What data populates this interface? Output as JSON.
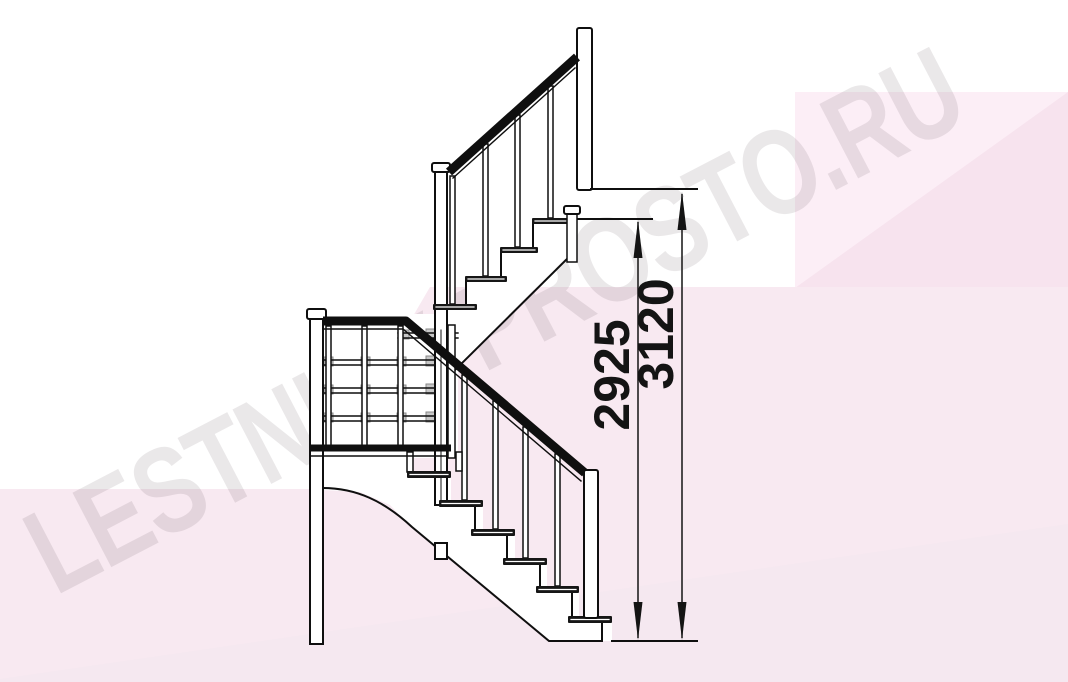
{
  "watermark": {
    "text": "LESTNICY-PROSTO.RU"
  },
  "dimensions": {
    "inner": {
      "value": "2925"
    },
    "outer": {
      "value": "3120"
    }
  },
  "drawing": {
    "subject": "staircase-side-elevation-with-winder",
    "upper_flight_treads": 4,
    "lower_flight_treads": 6
  },
  "colors": {
    "line": "#0f0f0f",
    "tread_fill": "#161616",
    "background_band": "#f8e9f1",
    "background_block_light": "#fceef6",
    "background_wedge_dark": "#f7e3ee",
    "background_bottom_wedge": "#f5e8f0",
    "watermark_gray": "rgba(82,64,76,0.12)"
  }
}
